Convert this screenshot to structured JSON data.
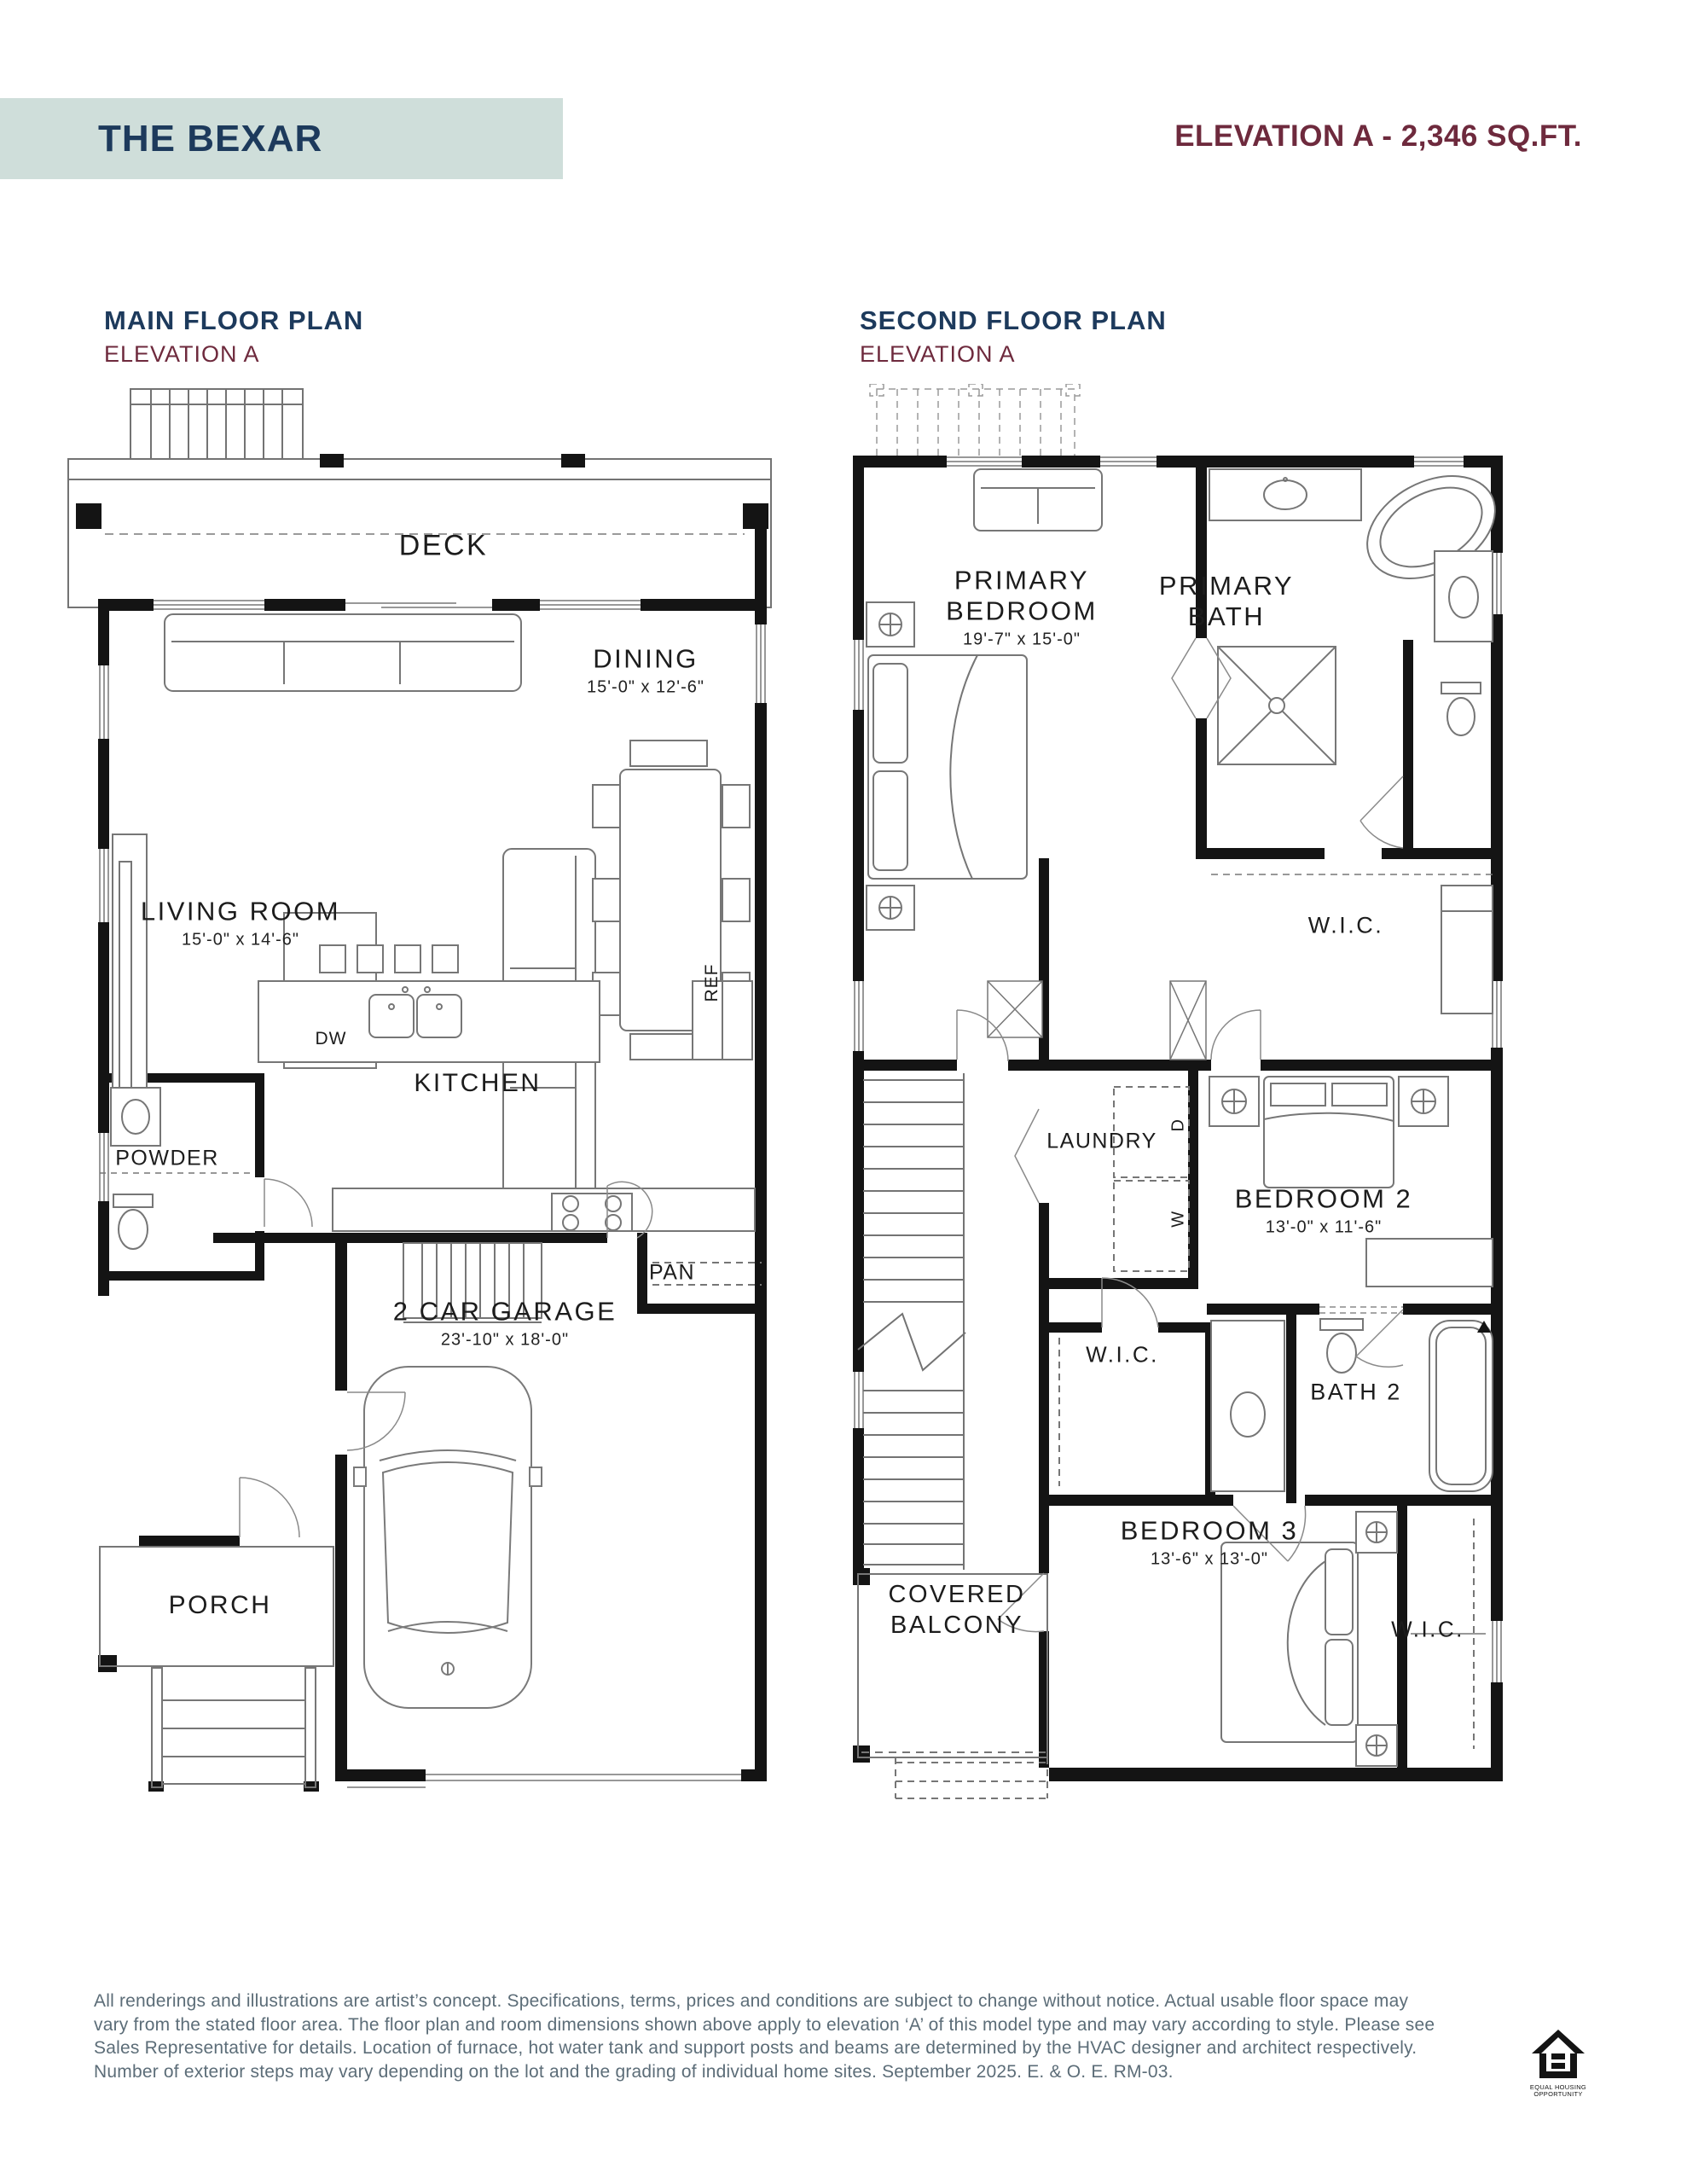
{
  "header": {
    "plan_name": "THE BEXAR",
    "elevation_info": "ELEVATION A - 2,346 SQ.FT."
  },
  "main_floor": {
    "title": "MAIN FLOOR PLAN",
    "subtitle": "ELEVATION A",
    "labels": {
      "deck": "DECK",
      "dining": {
        "name": "DINING",
        "dims": "15'-0\" x 12'-6\""
      },
      "living": {
        "name": "LIVING ROOM",
        "dims": "15'-0\" x 14'-6\""
      },
      "kitchen": "KITCHEN",
      "dishwasher": "DW",
      "fridge": "REF",
      "powder": "POWDER",
      "pantry": "PAN",
      "garage": {
        "name": "2 CAR GARAGE",
        "dims": "23'-10\" x 18'-0\""
      },
      "porch": "PORCH"
    }
  },
  "second_floor": {
    "title": "SECOND FLOOR PLAN",
    "subtitle": "ELEVATION A",
    "labels": {
      "primary_bedroom": {
        "line1": "PRIMARY",
        "line2": "BEDROOM",
        "dims": "19'-7\" x 15'-0\""
      },
      "primary_bath": {
        "line1": "PRIMARY",
        "line2": "BATH"
      },
      "wic_primary": "W.I.C.",
      "laundry": "LAUNDRY",
      "washer": "W",
      "dryer": "D",
      "bedroom2": {
        "name": "BEDROOM 2",
        "dims": "13'-0\" x 11'-6\""
      },
      "wic_bedroom2": "W.I.C.",
      "bath2": "BATH 2",
      "bedroom3": {
        "name": "BEDROOM 3",
        "dims": "13'-6\" x 13'-0\""
      },
      "covered_balcony": {
        "line1": "COVERED",
        "line2": "BALCONY"
      },
      "wic_bedroom3": "W.I.C."
    }
  },
  "footer": {
    "disclaimer_lines": [
      "All renderings and illustrations are artist’s concept. Specifications, terms, prices and conditions are subject to change without notice. Actual usable floor space may",
      "vary from the stated floor area. The floor plan and room dimensions shown above apply to elevation ‘A’ of this model type and may vary according to style. Please see",
      "Sales Representative for details. Location of furnace, hot water tank and support posts and beams are determined by the HVAC designer and architect respectively.",
      "Number of exterior steps may vary depending on the lot and the grading of individual home sites. September 2025. E. & O. E. RM-03."
    ],
    "eho": {
      "line1": "EQUAL HOUSING",
      "line2": "OPPORTUNITY"
    }
  },
  "colors": {
    "banner": "#cfdeda",
    "navy": "#1d3a5c",
    "maroon": "#6e2a3d",
    "footer_text": "#5c6d78",
    "walls": "#141414"
  }
}
